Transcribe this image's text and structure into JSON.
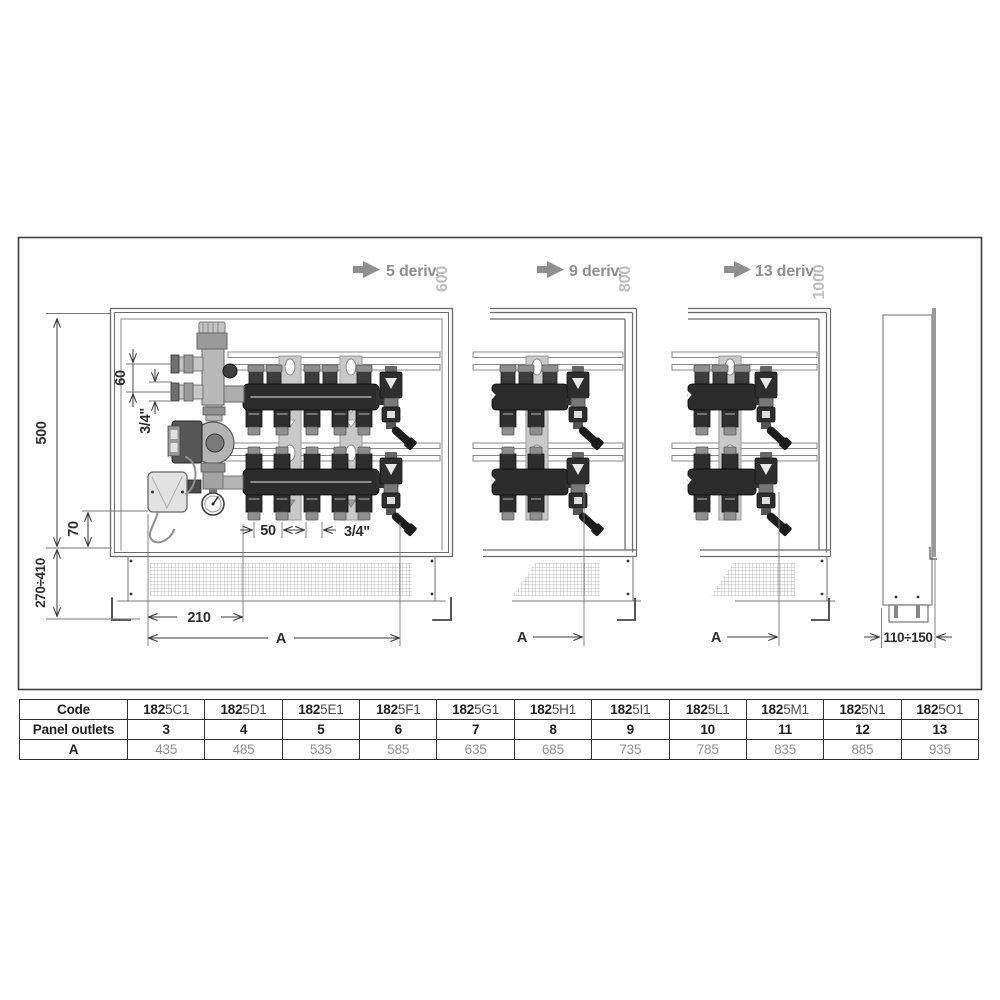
{
  "drawing": {
    "variants": [
      {
        "name": "5 deriv.",
        "height": "600"
      },
      {
        "name": "9 deriv.",
        "height": "800"
      },
      {
        "name": "13 deriv.",
        "height": "1000"
      }
    ],
    "dims": {
      "cabinet_height": "500",
      "pipe_spacing": "60",
      "pipe_size_top": "3/4\"",
      "box_offset": "70",
      "install_range": "270÷410",
      "pump_offset": "210",
      "width_ref": "A",
      "outlet_spacing": "50",
      "outlet_size": "3/4\"",
      "depth_range": "110÷150"
    }
  },
  "table": {
    "code": {
      "label": "Code",
      "cells": [
        {
          "b": "182",
          "r": "5C1"
        },
        {
          "b": "182",
          "r": "5D1"
        },
        {
          "b": "182",
          "r": "5E1"
        },
        {
          "b": "182",
          "r": "5F1"
        },
        {
          "b": "182",
          "r": "5G1"
        },
        {
          "b": "182",
          "r": "5H1"
        },
        {
          "b": "182",
          "r": "5I1"
        },
        {
          "b": "182",
          "r": "5L1"
        },
        {
          "b": "182",
          "r": "5M1"
        },
        {
          "b": "182",
          "r": "5N1"
        },
        {
          "b": "182",
          "r": "5O1"
        }
      ]
    },
    "outlets": {
      "label": "Panel outlets",
      "cells": [
        "3",
        "4",
        "5",
        "6",
        "7",
        "8",
        "9",
        "10",
        "11",
        "12",
        "13"
      ]
    },
    "a": {
      "label": "A",
      "cells": [
        "435",
        "485",
        "535",
        "585",
        "635",
        "685",
        "735",
        "785",
        "835",
        "885",
        "935"
      ]
    }
  }
}
